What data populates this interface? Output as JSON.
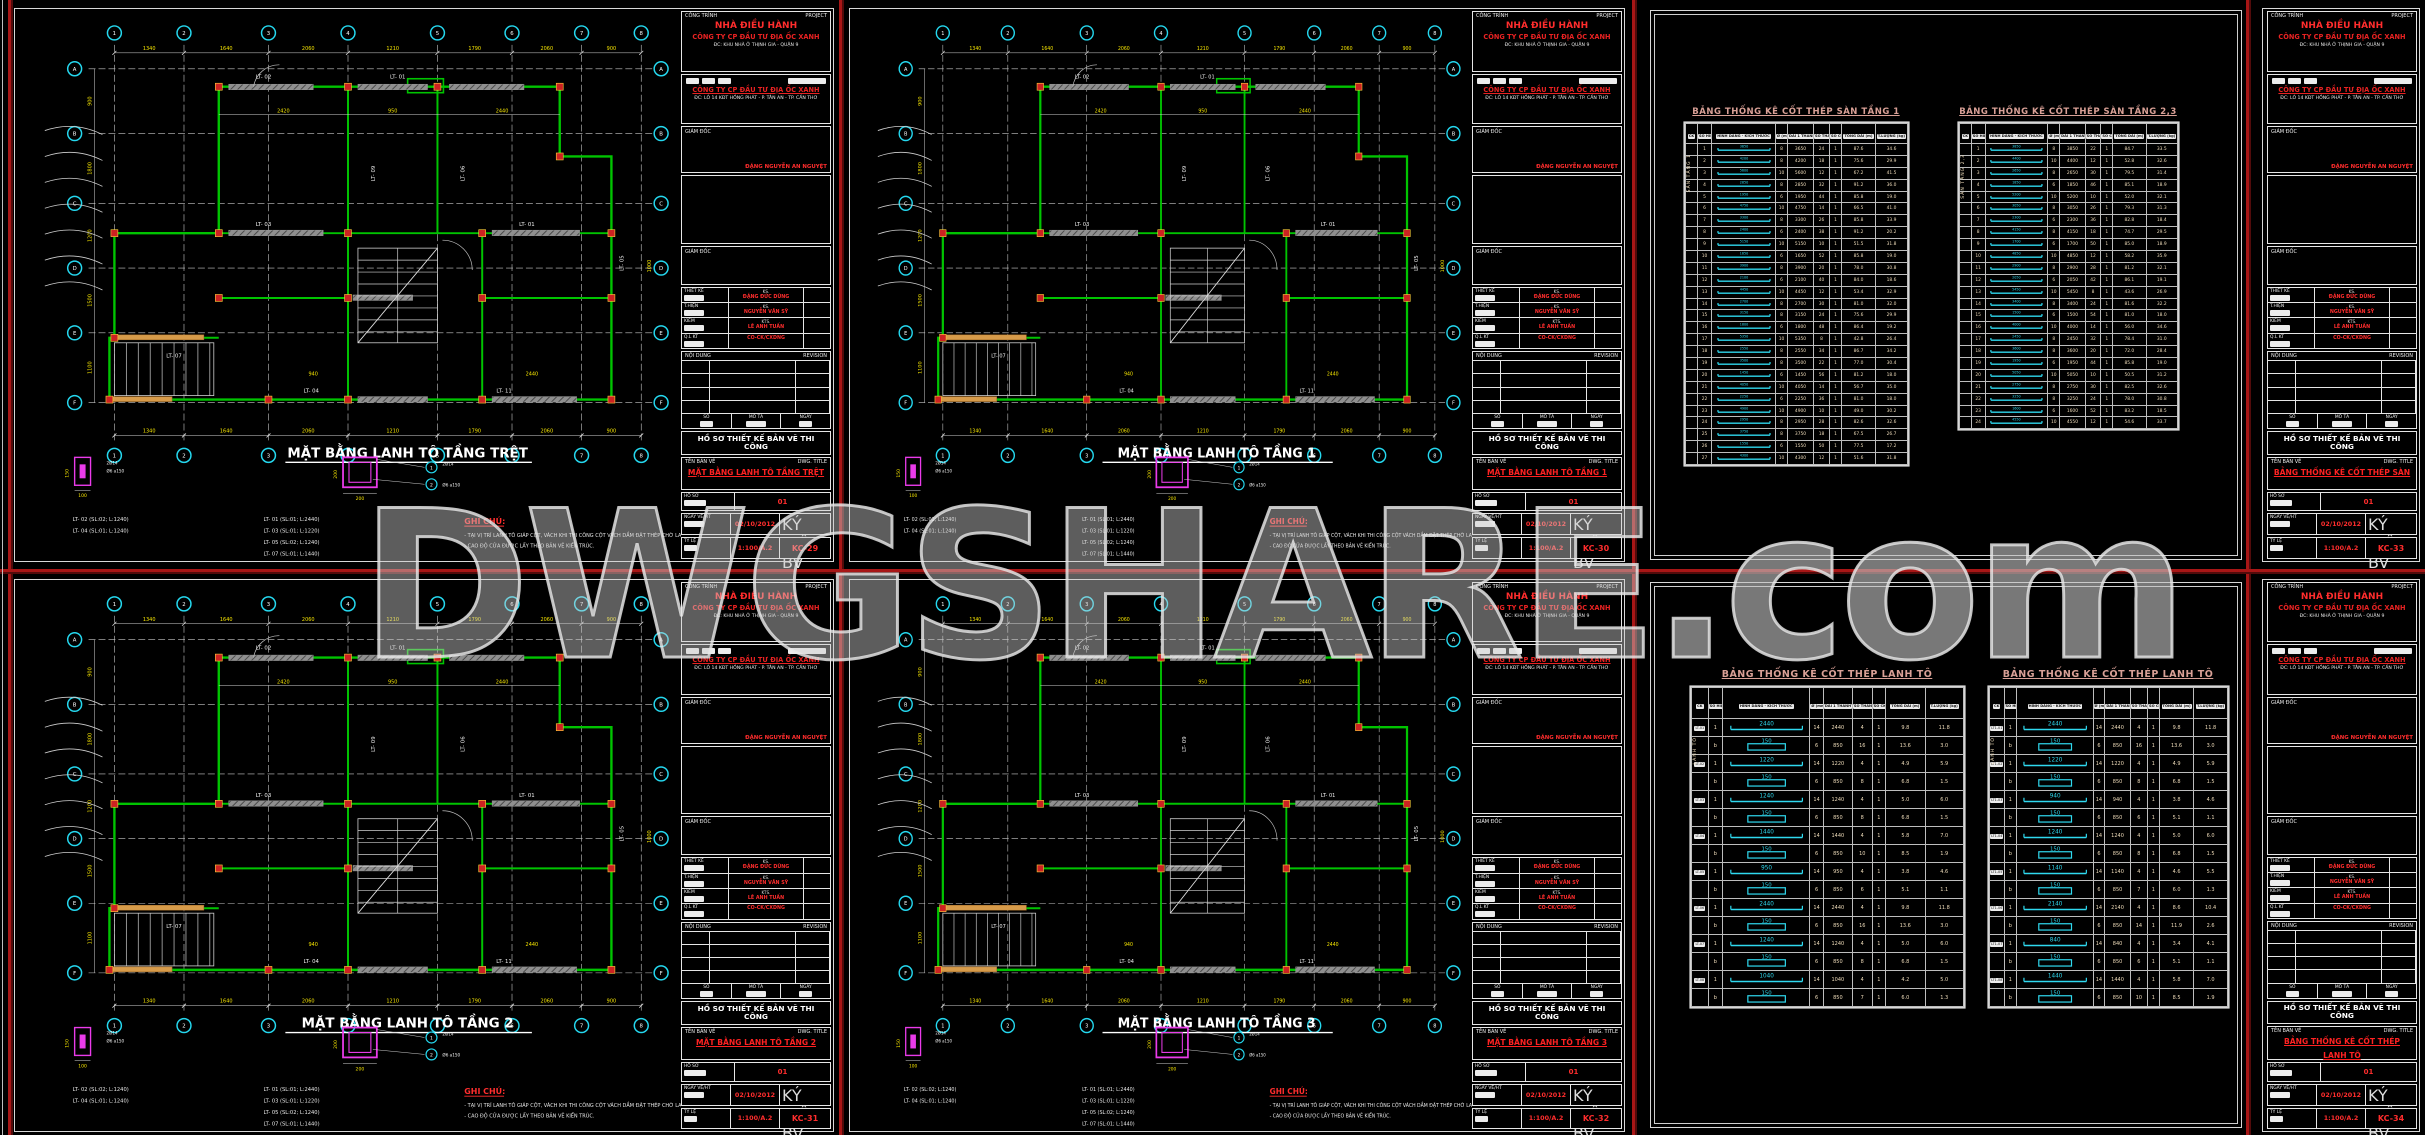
{
  "watermark": {
    "text": "DWGSHARE",
    "suffix": ".com"
  },
  "colors": {
    "background": "#000000",
    "separator_red": "#a81616",
    "wall_green": "#00c400",
    "column_red": "#cc2222",
    "dim_yellow": "#f5e400",
    "bubble_cyan": "#25d8ef",
    "detail_magenta": "#ea3bea",
    "table_title": "#d9a096",
    "rebar_cyan": "#2fd9ef",
    "value_cream": "#efdcba",
    "titleblock_red": "#ff2d2d"
  },
  "tb": {
    "project_label": "CÔNG TRÌNH",
    "project_label_en": "PROJECT",
    "project_name": "NHÀ ĐIỀU HÀNH",
    "investor": "CÔNG TY CP ĐẦU TƯ ĐỊA ỐC XANH",
    "project_addr": "ĐC: KHU NHÀ Ở THỊNH GIA - QUẬN 9",
    "owner_label": "CHỦ ĐẦU TƯ",
    "company": "CÔNG TY CP ĐẦU TƯ ĐỊA ỐC XANH",
    "company_addr": "ĐC: LÔ 14 KĐT HỒNG PHÁT - P. TÂN AN - TP. CẦN THƠ",
    "director_label": "GIÁM ĐỐC",
    "director_name": "ĐẶNG NGUYỄN AN NGUYỆT",
    "staff": [
      {
        "role": "THIẾT KẾ",
        "deg": "KS.",
        "name": "ĐẶNG ĐỨC DŨNG"
      },
      {
        "role": "T.HIỆN",
        "deg": "KS.",
        "name": "NGUYỄN VĂN SỸ"
      },
      {
        "role": "KIỂM",
        "deg": "KTS.",
        "name": "LÊ ANH TUẤN"
      },
      {
        "role": "Q.L KT",
        "deg": "",
        "name": "CO-CK/CXDNG"
      }
    ],
    "revision_label": "NỘI DUNG",
    "revision_label_en": "REVISION",
    "rev_cols": [
      "SỐ",
      "MÔ TẢ",
      "NGÀY"
    ],
    "doc_type": "HỒ SƠ THIẾT KẾ BẢN VẼ THI CÔNG",
    "dwg_label": "TÊN BẢN VẼ",
    "dwg_label_en": "DWG. TITLE",
    "profile_label": "HỒ SƠ",
    "profile_no": "01",
    "date_label": "NGÀY VẼ/HT",
    "sym_label": "KÝ HIỆU BV",
    "scale_label": "TỶ LỆ"
  },
  "sheets": [
    {
      "title": "MẶT BẰNG LANH TÔ TẦNG TRỆT",
      "date": "02/10/2012",
      "scale": "1:100/A.2",
      "number": "KC-29"
    },
    {
      "title": "MẶT BẰNG LANH TÔ TẦNG 1",
      "date": "02/10/2012",
      "scale": "1:100/A.2",
      "number": "KC-30"
    },
    {
      "title": "BẢNG THỐNG KÊ CỐT THÉP SÀN",
      "date": "02/10/2012",
      "scale": "1:100/A.2",
      "number": "KC-33"
    },
    {
      "title": "MẶT BẰNG LANH TÔ TẦNG 2",
      "date": "02/10/2012",
      "scale": "1:100/A.2",
      "number": "KC-31"
    },
    {
      "title": "MẶT BẰNG LANH TÔ TẦNG 3",
      "date": "02/10/2012",
      "scale": "1:100/A.2",
      "number": "KC-32"
    },
    {
      "title": "BẢNG THỐNG KÊ CỐT THÉP LANH TÔ",
      "date": "02/10/2012",
      "scale": "1:100/A.2",
      "number": "KC-34"
    }
  ],
  "plan": {
    "grid_top": [
      "1",
      "2",
      "3",
      "4",
      "5",
      "6",
      "7",
      "8"
    ],
    "grid_side": [
      "A",
      "B",
      "C",
      "D",
      "E",
      "F"
    ],
    "dims_top": [
      "1340",
      "1640",
      "2060",
      "1210",
      "1790",
      "2060",
      "900"
    ],
    "dims_side": [
      "900",
      "1800",
      "1200",
      "1500",
      "1100"
    ],
    "inner_dims": [
      "2420",
      "950",
      "2440",
      "940",
      "2440",
      "1000"
    ],
    "bar_labels": [
      "LT- 01",
      "LT- 02",
      "LT- 03",
      "LT- 04",
      "LT- 05",
      "LT- 06",
      "LT- 07",
      "LT- 08",
      "LT- 09",
      "LT- 11"
    ],
    "legend_col1": [
      "LT- 02 (SL:02; L:1240)",
      "LT- 04 (SL:01; L:1240)"
    ],
    "legend_col2": [
      "LT- 01 (SL:01; L:2440)",
      "LT- 03 (SL:01; L:1220)",
      "LT- 05 (SL:02; L:1240)",
      "LT- 07 (SL:01; L:1440)"
    ],
    "notes_title": "GHI CHÚ:",
    "notes": [
      "- TẠI VỊ TRÍ LANH TÔ GIÁP CỘT, VÁCH  KHI THI CÔNG CỘT VÁCH DẦM ĐẶT THÉP CHỜ LANH TÔ.",
      "- CAO ĐỘ CỬA ĐƯỢC LẤY THEO BẢN VẼ KIẾN TRÚC."
    ],
    "detail_a_labels": [
      "2Ø14",
      "Ø6 a150",
      "100",
      "150"
    ],
    "detail_b_labels": [
      "2Ø14",
      "Ø6 a150",
      "200",
      "200"
    ],
    "section_marks": [
      "1",
      "2"
    ]
  },
  "rebar_headers": [
    "CK",
    "SỐ HIỆU",
    "HÌNH DÁNG - KÍCH THƯỚC",
    "Ø (mm)",
    "DÀI 1 THANH",
    "SỐ THANH",
    "SỐ CK",
    "TỔNG DÀI (m)",
    "T.LƯỢNG (kg)"
  ],
  "steel_tables": {
    "san1": {
      "title": "BẢNG THỐNG KÊ CỐT THÉP SÀN TẦNG 1",
      "member": "SÀN TẦNG 1",
      "rows": [
        [
          "1",
          "3650",
          "bar",
          "8",
          "3650",
          "24",
          "1",
          "87.6",
          "34.6"
        ],
        [
          "2",
          "4200",
          "bar",
          "8",
          "4200",
          "18",
          "1",
          "75.6",
          "29.9"
        ],
        [
          "3",
          "5600",
          "bar",
          "10",
          "5600",
          "12",
          "1",
          "67.2",
          "41.5"
        ],
        [
          "4",
          "2850",
          "bar",
          "8",
          "2850",
          "32",
          "1",
          "91.2",
          "36.0"
        ],
        [
          "5",
          "1950",
          "bar",
          "6",
          "1950",
          "44",
          "1",
          "85.8",
          "19.0"
        ],
        [
          "6",
          "4750",
          "bar",
          "10",
          "4750",
          "14",
          "1",
          "66.5",
          "41.0"
        ],
        [
          "7",
          "3300",
          "bar",
          "8",
          "3300",
          "26",
          "1",
          "85.8",
          "33.9"
        ],
        [
          "8",
          "2400",
          "bar",
          "6",
          "2400",
          "38",
          "1",
          "91.2",
          "20.2"
        ],
        [
          "9",
          "5150",
          "bar",
          "10",
          "5150",
          "10",
          "1",
          "51.5",
          "31.8"
        ],
        [
          "10",
          "1650",
          "bar",
          "6",
          "1650",
          "52",
          "1",
          "85.8",
          "19.0"
        ],
        [
          "11",
          "3900",
          "bar",
          "8",
          "3900",
          "20",
          "1",
          "78.0",
          "30.8"
        ],
        [
          "12",
          "2100",
          "bar",
          "6",
          "2100",
          "40",
          "1",
          "84.0",
          "18.6"
        ],
        [
          "13",
          "4450",
          "bar",
          "10",
          "4450",
          "12",
          "1",
          "53.4",
          "32.9"
        ],
        [
          "14",
          "2700",
          "bar",
          "8",
          "2700",
          "30",
          "1",
          "81.0",
          "32.0"
        ],
        [
          "15",
          "3150",
          "bar",
          "8",
          "3150",
          "24",
          "1",
          "75.6",
          "29.9"
        ],
        [
          "16",
          "1800",
          "bar",
          "6",
          "1800",
          "48",
          "1",
          "86.4",
          "19.2"
        ],
        [
          "17",
          "5350",
          "bar",
          "10",
          "5350",
          "8",
          "1",
          "42.8",
          "26.4"
        ],
        [
          "18",
          "2550",
          "bar",
          "8",
          "2550",
          "34",
          "1",
          "86.7",
          "34.2"
        ],
        [
          "19",
          "3500",
          "bar",
          "8",
          "3500",
          "22",
          "1",
          "77.0",
          "30.4"
        ],
        [
          "20",
          "1450",
          "bar",
          "6",
          "1450",
          "56",
          "1",
          "81.2",
          "18.0"
        ],
        [
          "21",
          "4050",
          "bar",
          "10",
          "4050",
          "14",
          "1",
          "56.7",
          "35.0"
        ],
        [
          "22",
          "2250",
          "bar",
          "6",
          "2250",
          "36",
          "1",
          "81.0",
          "18.0"
        ],
        [
          "23",
          "4900",
          "bar",
          "10",
          "4900",
          "10",
          "1",
          "49.0",
          "30.2"
        ],
        [
          "24",
          "2950",
          "bar",
          "8",
          "2950",
          "28",
          "1",
          "82.6",
          "32.6"
        ],
        [
          "25",
          "3750",
          "bar",
          "8",
          "3750",
          "18",
          "1",
          "67.5",
          "26.7"
        ],
        [
          "26",
          "1550",
          "bar",
          "6",
          "1550",
          "50",
          "1",
          "77.5",
          "17.2"
        ],
        [
          "27",
          "4300",
          "bar",
          "10",
          "4300",
          "12",
          "1",
          "51.6",
          "31.8"
        ]
      ]
    },
    "san23": {
      "title": "BẢNG THỐNG KÊ CỐT THÉP SÀN TẦNG 2,3",
      "member": "SÀN TẦNG 2,3",
      "rows": [
        [
          "1",
          "3850",
          "bar",
          "8",
          "3850",
          "22",
          "1",
          "84.7",
          "33.5"
        ],
        [
          "2",
          "4400",
          "bar",
          "10",
          "4400",
          "12",
          "1",
          "52.8",
          "32.6"
        ],
        [
          "3",
          "2650",
          "bar",
          "8",
          "2650",
          "30",
          "1",
          "79.5",
          "31.4"
        ],
        [
          "4",
          "1850",
          "bar",
          "6",
          "1850",
          "46",
          "1",
          "85.1",
          "18.9"
        ],
        [
          "5",
          "5200",
          "bar",
          "10",
          "5200",
          "10",
          "1",
          "52.0",
          "32.1"
        ],
        [
          "6",
          "3050",
          "bar",
          "8",
          "3050",
          "26",
          "1",
          "79.3",
          "31.3"
        ],
        [
          "7",
          "2300",
          "bar",
          "6",
          "2300",
          "36",
          "1",
          "82.8",
          "18.4"
        ],
        [
          "8",
          "4150",
          "bar",
          "8",
          "4150",
          "18",
          "1",
          "74.7",
          "29.5"
        ],
        [
          "9",
          "1700",
          "bar",
          "6",
          "1700",
          "50",
          "1",
          "85.0",
          "18.9"
        ],
        [
          "10",
          "4850",
          "bar",
          "10",
          "4850",
          "12",
          "1",
          "58.2",
          "35.9"
        ],
        [
          "11",
          "2900",
          "bar",
          "8",
          "2900",
          "28",
          "1",
          "81.2",
          "32.1"
        ],
        [
          "12",
          "2050",
          "bar",
          "6",
          "2050",
          "42",
          "1",
          "86.1",
          "19.1"
        ],
        [
          "13",
          "5450",
          "bar",
          "10",
          "5450",
          "8",
          "1",
          "43.6",
          "26.9"
        ],
        [
          "14",
          "3400",
          "bar",
          "8",
          "3400",
          "24",
          "1",
          "81.6",
          "32.2"
        ],
        [
          "15",
          "1500",
          "bar",
          "6",
          "1500",
          "54",
          "1",
          "81.0",
          "18.0"
        ],
        [
          "16",
          "4000",
          "bar",
          "10",
          "4000",
          "14",
          "1",
          "56.0",
          "34.6"
        ],
        [
          "17",
          "2450",
          "bar",
          "8",
          "2450",
          "32",
          "1",
          "78.4",
          "31.0"
        ],
        [
          "18",
          "3600",
          "bar",
          "8",
          "3600",
          "20",
          "1",
          "72.0",
          "28.4"
        ],
        [
          "19",
          "1950",
          "bar",
          "6",
          "1950",
          "44",
          "1",
          "85.8",
          "19.0"
        ],
        [
          "20",
          "5050",
          "bar",
          "10",
          "5050",
          "10",
          "1",
          "50.5",
          "31.2"
        ],
        [
          "21",
          "2750",
          "bar",
          "8",
          "2750",
          "30",
          "1",
          "82.5",
          "32.6"
        ],
        [
          "22",
          "3250",
          "bar",
          "8",
          "3250",
          "24",
          "1",
          "78.0",
          "30.8"
        ],
        [
          "23",
          "1600",
          "bar",
          "6",
          "1600",
          "52",
          "1",
          "83.2",
          "18.5"
        ],
        [
          "24",
          "4550",
          "bar",
          "10",
          "4550",
          "12",
          "1",
          "54.6",
          "33.7"
        ]
      ]
    },
    "lanhto1": {
      "title": "BẢNG THỐNG KÊ CỐT THÉP LANH TÔ",
      "member": "LANH TÔ",
      "rows": [
        [
          "LT-01",
          "1",
          "2440",
          "bar",
          "14",
          "2440",
          "4",
          "1",
          "9.8",
          "11.8"
        ],
        [
          "",
          "b",
          "150",
          "stirrup",
          "6",
          "850",
          "16",
          "1",
          "13.6",
          "3.0"
        ],
        [
          "LT-02",
          "1",
          "1220",
          "bar",
          "14",
          "1220",
          "4",
          "1",
          "4.9",
          "5.9"
        ],
        [
          "",
          "b",
          "150",
          "stirrup",
          "6",
          "850",
          "8",
          "1",
          "6.8",
          "1.5"
        ],
        [
          "LT-03",
          "1",
          "1240",
          "bar",
          "14",
          "1240",
          "4",
          "1",
          "5.0",
          "6.0"
        ],
        [
          "",
          "b",
          "150",
          "stirrup",
          "6",
          "850",
          "8",
          "1",
          "6.8",
          "1.5"
        ],
        [
          "LT-04",
          "1",
          "1440",
          "bar",
          "14",
          "1440",
          "4",
          "1",
          "5.8",
          "7.0"
        ],
        [
          "",
          "b",
          "150",
          "stirrup",
          "6",
          "850",
          "10",
          "1",
          "8.5",
          "1.9"
        ],
        [
          "LT-05",
          "1",
          "950",
          "bar",
          "14",
          "950",
          "4",
          "1",
          "3.8",
          "4.6"
        ],
        [
          "",
          "b",
          "150",
          "stirrup",
          "6",
          "850",
          "6",
          "1",
          "5.1",
          "1.1"
        ],
        [
          "LT-06",
          "1",
          "2440",
          "bar",
          "14",
          "2440",
          "4",
          "1",
          "9.8",
          "11.8"
        ],
        [
          "",
          "b",
          "150",
          "stirrup",
          "6",
          "850",
          "16",
          "1",
          "13.6",
          "3.0"
        ],
        [
          "LT-07",
          "1",
          "1240",
          "bar",
          "14",
          "1240",
          "4",
          "1",
          "5.0",
          "6.0"
        ],
        [
          "",
          "b",
          "150",
          "stirrup",
          "6",
          "850",
          "8",
          "1",
          "6.8",
          "1.5"
        ],
        [
          "LT-08",
          "1",
          "1040",
          "bar",
          "14",
          "1040",
          "4",
          "1",
          "4.2",
          "5.0"
        ],
        [
          "",
          "b",
          "150",
          "stirrup",
          "6",
          "850",
          "7",
          "1",
          "6.0",
          "1.3"
        ]
      ]
    },
    "lanhto2": {
      "title": "BẢNG THỐNG KÊ CỐT THÉP LANH TÔ",
      "member": "LANH TÔ",
      "rows": [
        [
          "LT1-01",
          "1",
          "2440",
          "bar",
          "14",
          "2440",
          "4",
          "1",
          "9.8",
          "11.8"
        ],
        [
          "",
          "b",
          "150",
          "stirrup",
          "6",
          "850",
          "16",
          "1",
          "13.6",
          "3.0"
        ],
        [
          "LT1-02",
          "1",
          "1220",
          "bar",
          "14",
          "1220",
          "4",
          "1",
          "4.9",
          "5.9"
        ],
        [
          "",
          "b",
          "150",
          "stirrup",
          "6",
          "850",
          "8",
          "1",
          "6.8",
          "1.5"
        ],
        [
          "LT1-03",
          "1",
          "940",
          "bar",
          "14",
          "940",
          "4",
          "1",
          "3.8",
          "4.6"
        ],
        [
          "",
          "b",
          "150",
          "stirrup",
          "6",
          "850",
          "6",
          "1",
          "5.1",
          "1.1"
        ],
        [
          "LT1-04",
          "1",
          "1240",
          "bar",
          "14",
          "1240",
          "4",
          "1",
          "5.0",
          "6.0"
        ],
        [
          "",
          "b",
          "150",
          "stirrup",
          "6",
          "850",
          "8",
          "1",
          "6.8",
          "1.5"
        ],
        [
          "LT1-05",
          "1",
          "1140",
          "bar",
          "14",
          "1140",
          "4",
          "1",
          "4.6",
          "5.5"
        ],
        [
          "",
          "b",
          "150",
          "stirrup",
          "6",
          "850",
          "7",
          "1",
          "6.0",
          "1.3"
        ],
        [
          "LT1-06",
          "1",
          "2140",
          "bar",
          "14",
          "2140",
          "4",
          "1",
          "8.6",
          "10.4"
        ],
        [
          "",
          "b",
          "150",
          "stirrup",
          "6",
          "850",
          "14",
          "1",
          "11.9",
          "2.6"
        ],
        [
          "LT1-07",
          "1",
          "840",
          "bar",
          "14",
          "840",
          "4",
          "1",
          "3.4",
          "4.1"
        ],
        [
          "",
          "b",
          "150",
          "stirrup",
          "6",
          "850",
          "6",
          "1",
          "5.1",
          "1.1"
        ],
        [
          "LT1-08",
          "1",
          "1440",
          "bar",
          "14",
          "1440",
          "4",
          "1",
          "5.8",
          "7.0"
        ],
        [
          "",
          "b",
          "150",
          "stirrup",
          "6",
          "850",
          "10",
          "1",
          "8.5",
          "1.9"
        ]
      ]
    }
  }
}
